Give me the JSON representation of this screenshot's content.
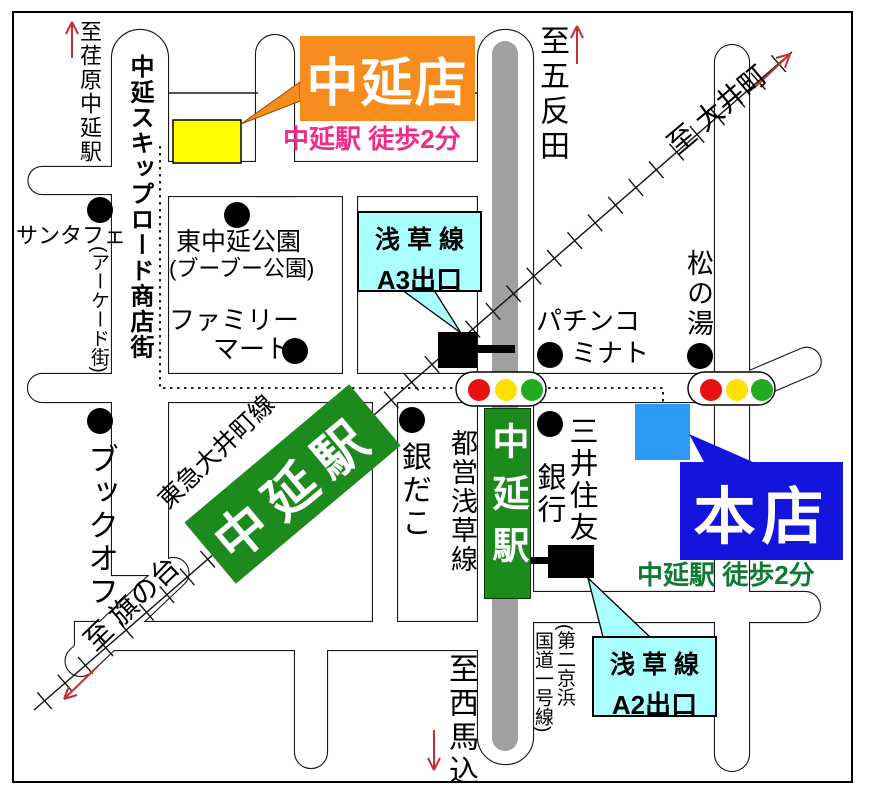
{
  "colors": {
    "branch_orange": "#F78C1E",
    "branch_note_magenta": "#EE2D88",
    "main_blue": "#1414DC",
    "marker_blue": "#2D9BF5",
    "station_green": "#1C8A1C",
    "main_note_green": "#107A35",
    "callout_cyan": "#AAFFFF",
    "road_gray": "#A0A0A0",
    "signal_red": "#E81010",
    "signal_yellow": "#FFE000",
    "signal_green": "#22AA22",
    "arrow_red": "#C03232",
    "branch_building_yellow": "#FFFF00"
  },
  "signs": {
    "branch": {
      "label": "中延店",
      "note": "中延駅 徒歩2分"
    },
    "main": {
      "label": "本店",
      "note": "中延駅 徒歩2分"
    }
  },
  "stations": {
    "tokyu_sign": "中延駅",
    "subway_sign": "中延駅",
    "tokyu_line": "東急大井町線",
    "subway_line": "都営浅草線"
  },
  "exits": {
    "a3": {
      "line": "浅 草 線",
      "name": "A3出口"
    },
    "a2": {
      "line": "浅 草 線",
      "name": "A2出口"
    }
  },
  "directions": {
    "ebara": "至荏原中延駅",
    "gotanda": "至五反田",
    "oimachi": "至 大井町",
    "hatanodai": "至 旗の台",
    "nishimagome": "至西馬込"
  },
  "roads": {
    "skip_road": "中延スキップロード商店街",
    "keihin_a": "(第二京浜",
    "keihin_b": "国道一号線)"
  },
  "landmarks": {
    "santafe": "サンタフェ",
    "arcade": "(アーケード街)",
    "park_line1": "東中延公園",
    "park_line2": "(ブーブー公園)",
    "family_line1": "ファミリー",
    "family_line2": "マート",
    "bookoff": "ブックオフ",
    "pachinko_line1": "パチンコ",
    "pachinko_line2": "ミナト",
    "matsunoyu": "松の湯",
    "gindako": "銀だこ",
    "bank_line1": "三井住友",
    "bank_line2": "銀行"
  },
  "traffic_light_colors": [
    "#E81010",
    "#FFE000",
    "#22AA22"
  ]
}
